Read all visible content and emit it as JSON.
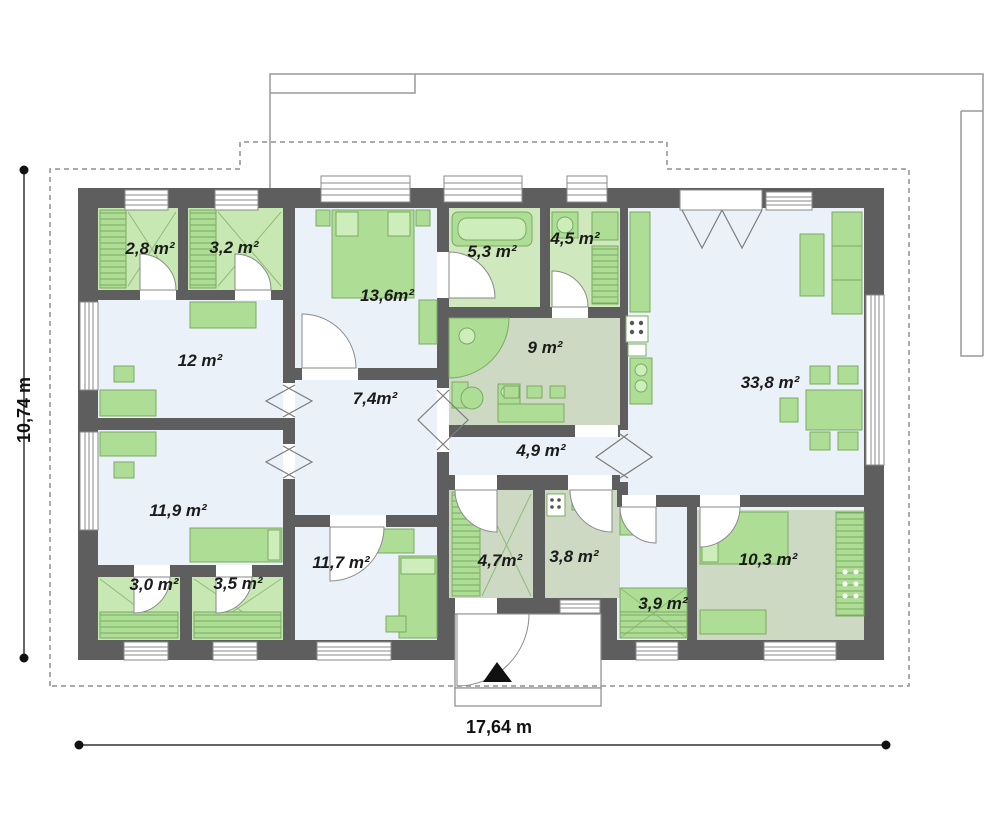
{
  "rooms": [
    {
      "id": "wardrobe-a",
      "area": "2,8 m²"
    },
    {
      "id": "wardrobe-b",
      "area": "3,2 m²"
    },
    {
      "id": "bedroom-large",
      "area": "13,6m²"
    },
    {
      "id": "bathroom",
      "area": "5,3 m²"
    },
    {
      "id": "utility",
      "area": "4,5 m²"
    },
    {
      "id": "room-12",
      "area": "12 m²"
    },
    {
      "id": "kitchen",
      "area": "9 m²"
    },
    {
      "id": "hall",
      "area": "7,4m²"
    },
    {
      "id": "living-room",
      "area": "33,8 m²"
    },
    {
      "id": "corridor",
      "area": "4,9 m²"
    },
    {
      "id": "room-11-9",
      "area": "11,9 m²"
    },
    {
      "id": "room-11-7",
      "area": "11,7 m²"
    },
    {
      "id": "vestibule",
      "area": "4,7m²"
    },
    {
      "id": "boiler-room",
      "area": "3,8 m²"
    },
    {
      "id": "closet-3-9",
      "area": "3,9 m²"
    },
    {
      "id": "bedroom-10-3",
      "area": "10,3 m²"
    },
    {
      "id": "wc",
      "area": "3,0 m²"
    },
    {
      "id": "closet-3-5",
      "area": "3,5 m²"
    }
  ],
  "dimensions": {
    "width_label": "17,64 m",
    "height_label": "10,74 m"
  },
  "colors": {
    "wall": "#5d5e5d",
    "room_light": "#ebf1f8",
    "room_green": "#c7e8b2",
    "room_sage": "#cdd9c3",
    "furniture": "#aede96",
    "furniture_stroke": "#7bab62",
    "dashed_outline": "#8f8f8f"
  }
}
